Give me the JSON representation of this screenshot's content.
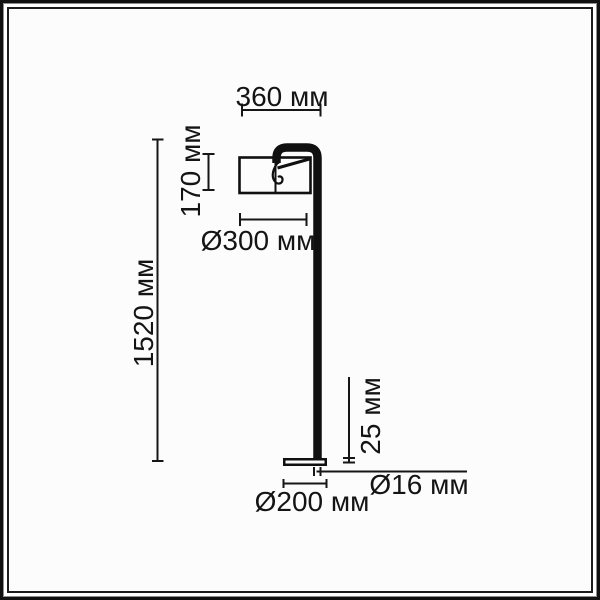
{
  "meta": {
    "type": "technical dimension diagram",
    "subject": "floor lamp, side view"
  },
  "unit": "мм",
  "colors": {
    "ink": "#101010",
    "background": "#fcfcfc",
    "frame_outer": "#101010",
    "frame_gray": "#8f8f8f",
    "frame_inner": "#1d1d1d"
  },
  "dimensions": {
    "head_width": {
      "value": 360,
      "label": "360 мм"
    },
    "shade_height": {
      "value": 170,
      "label": "170 мм"
    },
    "shade_diameter": {
      "value": 300,
      "label": "Ø300 мм"
    },
    "total_height": {
      "value": 1520,
      "label": "1520 мм"
    },
    "base_height": {
      "value": 25,
      "label": "25 мм"
    },
    "pole_diameter": {
      "value": 16,
      "label": "Ø16 мм"
    },
    "base_diameter": {
      "value": 200,
      "label": "Ø200 мм"
    }
  }
}
